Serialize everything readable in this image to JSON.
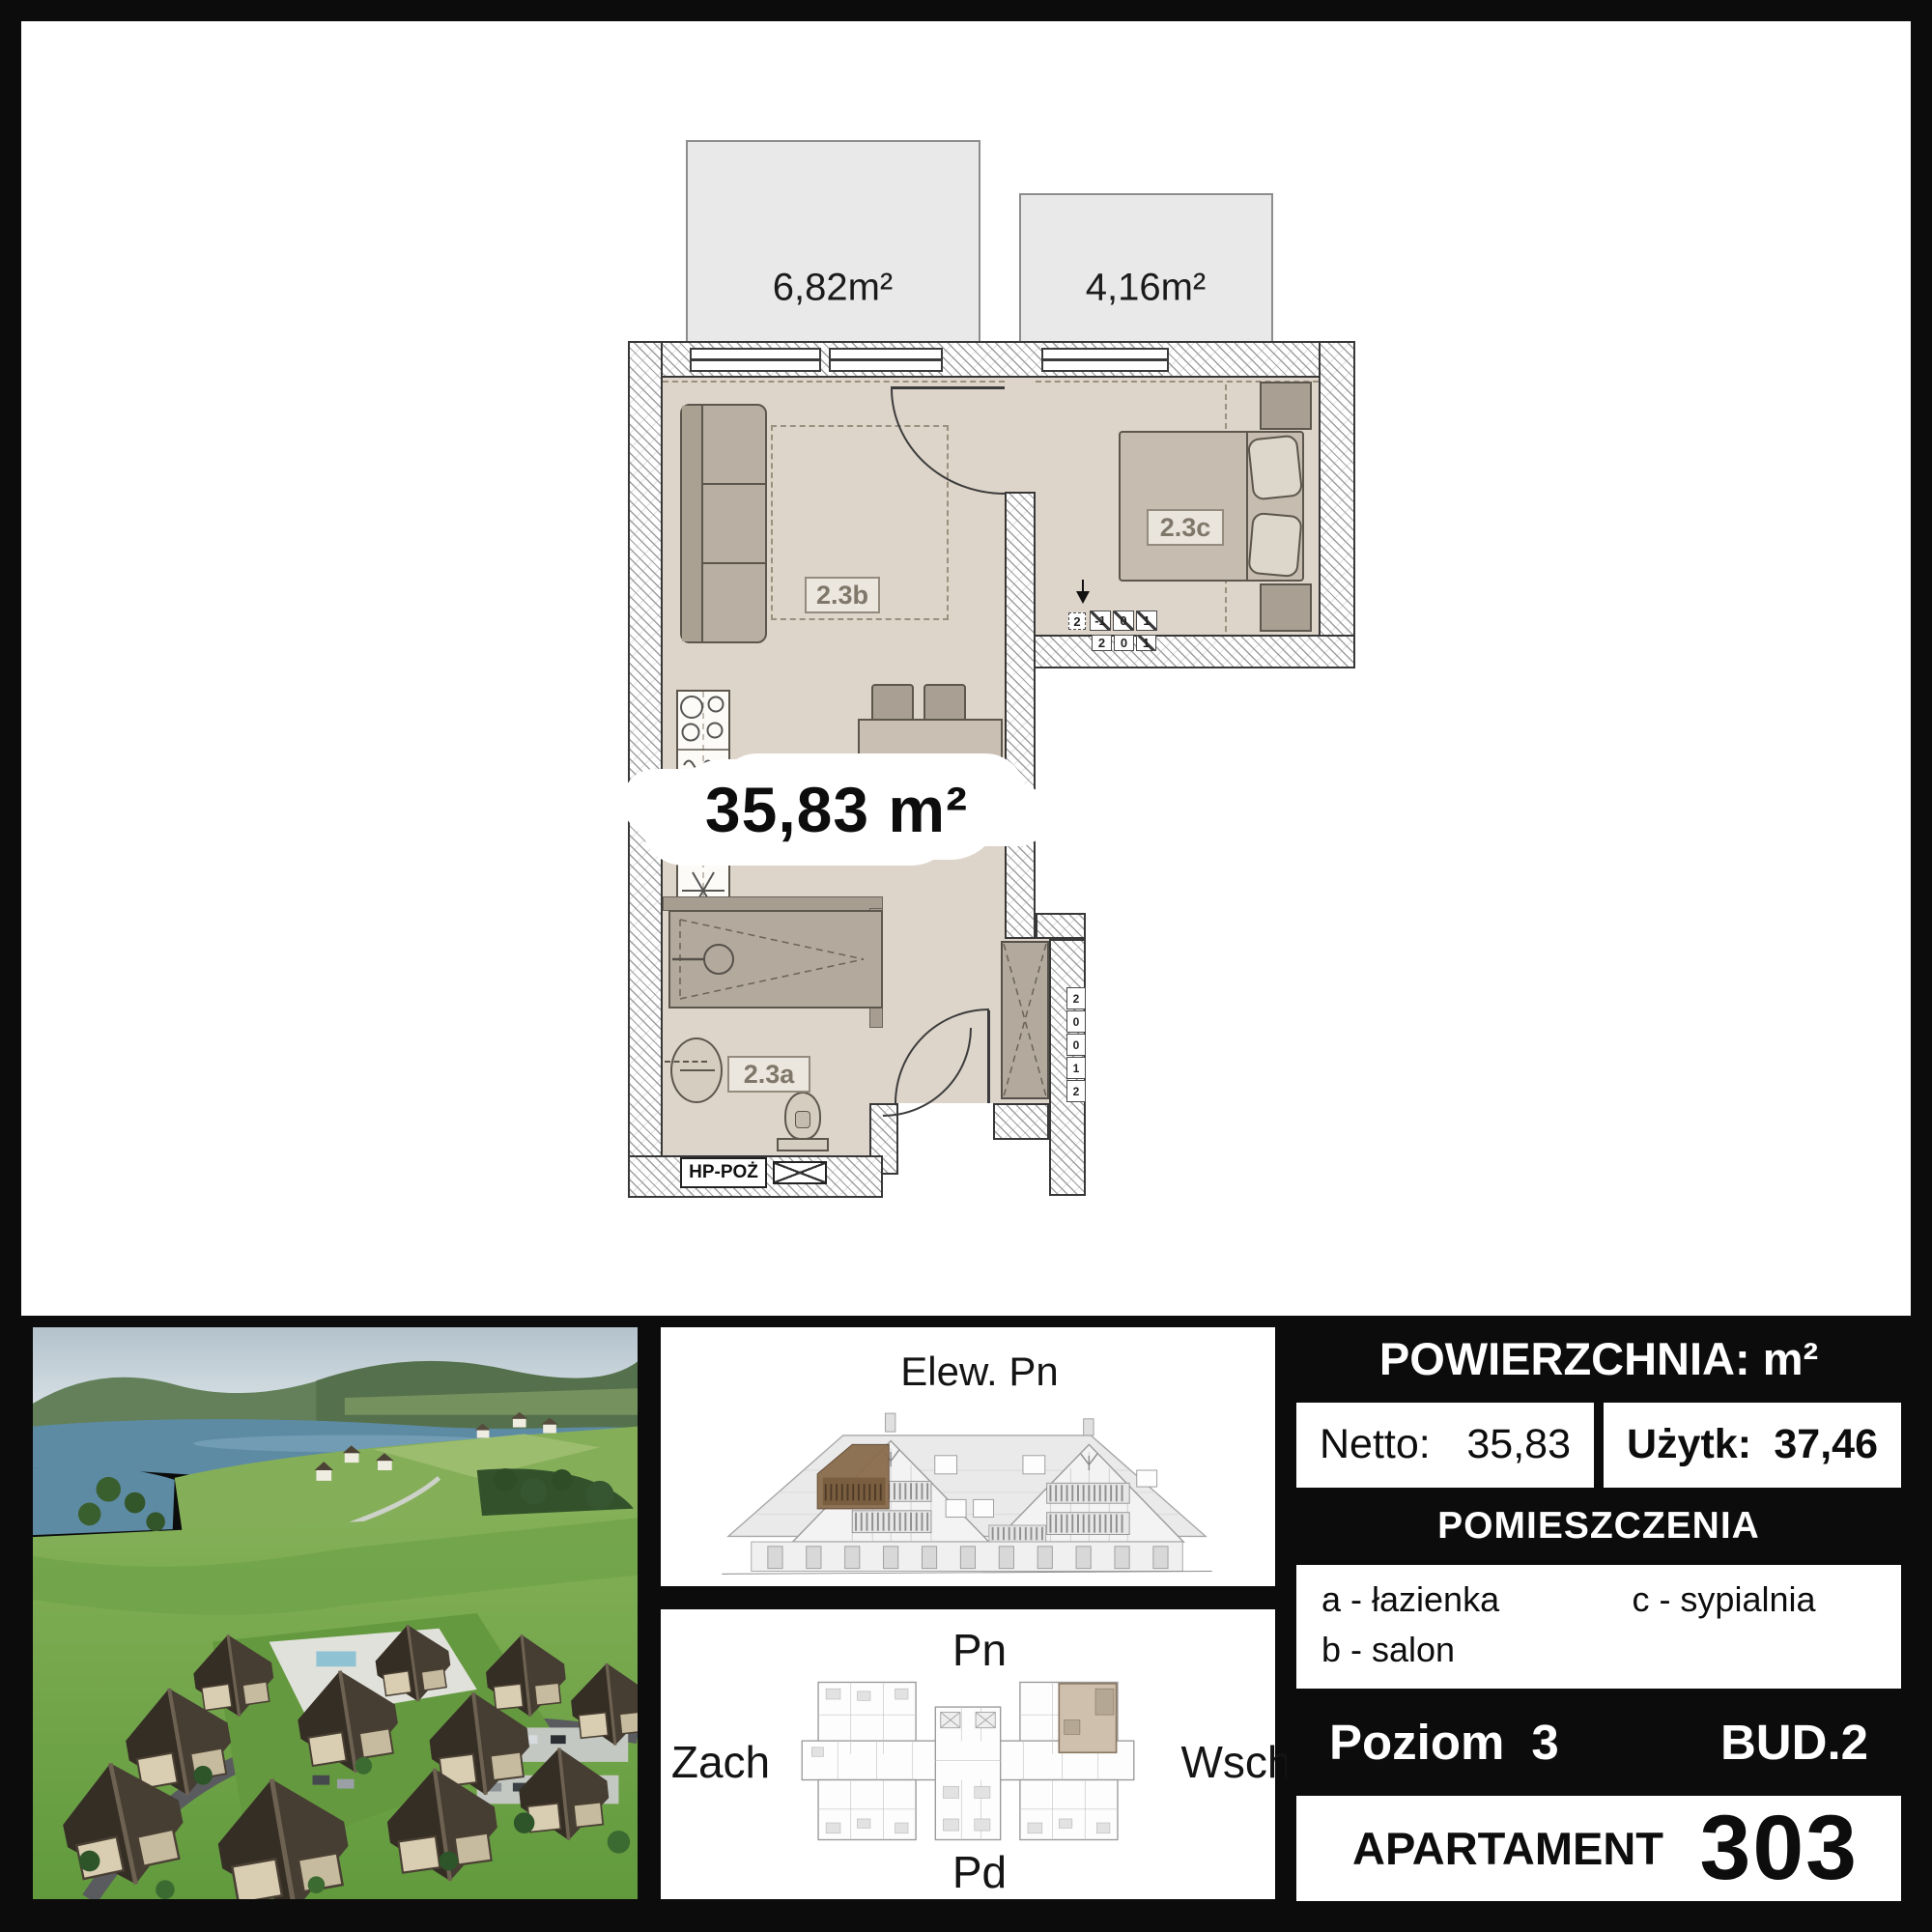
{
  "colors": {
    "floor_beige": "#ded5ca",
    "wall_ink": "#383838",
    "furniture_gray": "#b9b0a3",
    "balcony_gray": "#e9e9e9",
    "highlight_unit_beige": "#cfc0ad",
    "highlight_balcony_brown": "#8a6c4c",
    "panel_black": "#0c0c0c"
  },
  "plan": {
    "balcony_large": "6,82m²",
    "balcony_small": "4,16m²",
    "total_area": "35,83 m²",
    "room_living": "2.3b",
    "room_bedroom": "2.3c",
    "room_bath": "2.3a",
    "hydrant": "HP-POŻ",
    "level_top": [
      "2",
      "-1",
      "0",
      "1"
    ],
    "level_bottom": [
      "2",
      "0",
      "1"
    ],
    "stair_strip": [
      "2",
      "0",
      "0",
      "1",
      "2"
    ]
  },
  "elevation": {
    "title": "Elew. Pn"
  },
  "overview": {
    "north": "Pn",
    "south": "Pd",
    "west": "Zach",
    "east": "Wsch"
  },
  "info": {
    "header": "POWIERZCHNIA: m²",
    "netto_label": "Netto:",
    "netto_value": "35,83",
    "uzytk_label": "Użytk:",
    "uzytk_value": "37,46",
    "rooms_header": "POMIESZCZENIA",
    "legend_a": "a - łazienka",
    "legend_b": "b - salon",
    "legend_c": "c - sypialnia",
    "level_label": "Poziom",
    "level_value": "3",
    "building": "BUD.2",
    "apartment_label": "APARTAMENT",
    "apartment_number": "303"
  }
}
